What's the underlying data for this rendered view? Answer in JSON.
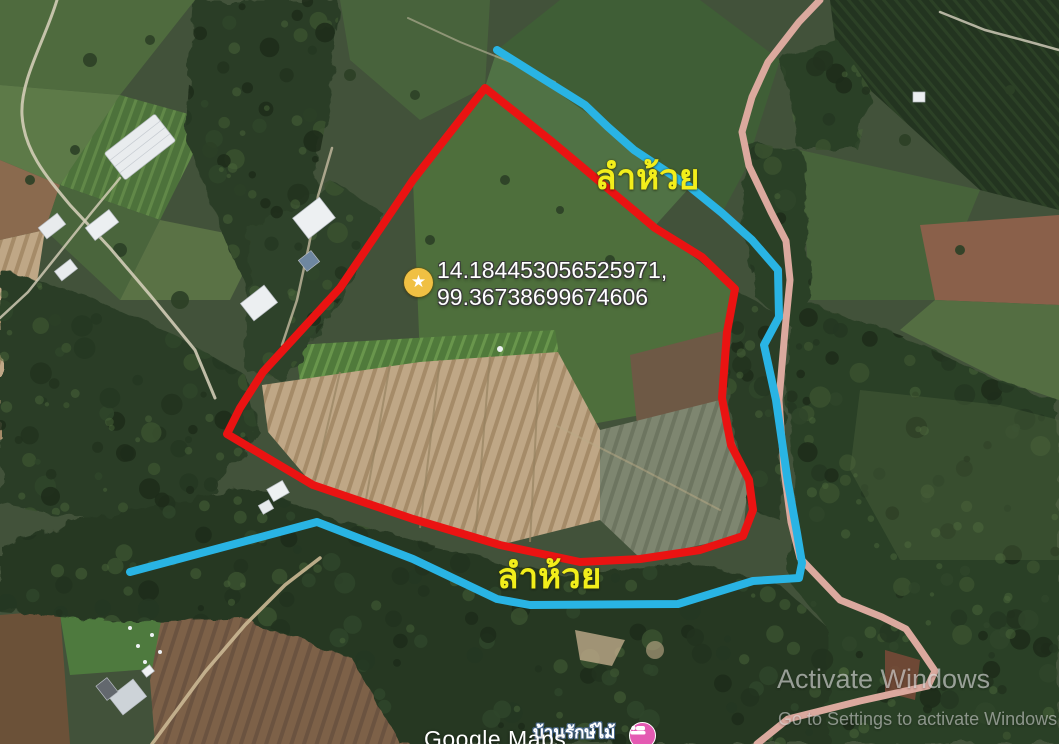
{
  "map": {
    "provider": "Google Maps",
    "marker": {
      "icon": "star-marker",
      "coordinates": [
        "14.184453056525971,",
        "99.36738699674606"
      ]
    },
    "labels": {
      "stream_top": "ลำห้วย",
      "stream_bottom": "ลำห้วย",
      "place": "บ้านรักษ์ไม้"
    },
    "overlays": {
      "road": {
        "name": "road-line",
        "color": "#dba99e",
        "width": 7,
        "closed": false,
        "points": [
          [
            820,
            0
          ],
          [
            799,
            22
          ],
          [
            768,
            62
          ],
          [
            752,
            97
          ],
          [
            742,
            132
          ],
          [
            749,
            166
          ],
          [
            771,
            212
          ],
          [
            786,
            241
          ],
          [
            790,
            280
          ],
          [
            785,
            330
          ],
          [
            779,
            400
          ],
          [
            784,
            470
          ],
          [
            791,
            522
          ],
          [
            800,
            558
          ],
          [
            840,
            600
          ],
          [
            882,
            617
          ],
          [
            906,
            629
          ],
          [
            918,
            646
          ],
          [
            935,
            671
          ],
          [
            928,
            686
          ],
          [
            860,
            701
          ],
          [
            788,
            719
          ],
          [
            757,
            744
          ]
        ]
      },
      "stream": {
        "name": "stream-line",
        "color": "#29b4e4",
        "width": 8,
        "closed": false,
        "points": [
          [
            497,
            50
          ],
          [
            585,
            105
          ],
          [
            608,
            127
          ],
          [
            634,
            150
          ],
          [
            690,
            187
          ],
          [
            722,
            213
          ],
          [
            752,
            240
          ],
          [
            778,
            270
          ],
          [
            779,
            317
          ],
          [
            764,
            345
          ],
          [
            776,
            400
          ],
          [
            788,
            483
          ],
          [
            797,
            533
          ],
          [
            802,
            563
          ],
          [
            799,
            578
          ],
          [
            753,
            581
          ],
          [
            678,
            604
          ],
          [
            530,
            605
          ],
          [
            497,
            599
          ],
          [
            413,
            559
          ],
          [
            317,
            522
          ],
          [
            130,
            572
          ]
        ]
      },
      "parcel_boundary": {
        "name": "land-parcel-outline",
        "color": "#ea1312",
        "width": 8,
        "closed": true,
        "points": [
          [
            485,
            88
          ],
          [
            550,
            140
          ],
          [
            655,
            228
          ],
          [
            702,
            257
          ],
          [
            735,
            289
          ],
          [
            727,
            332
          ],
          [
            722,
            398
          ],
          [
            731,
            445
          ],
          [
            749,
            480
          ],
          [
            753,
            510
          ],
          [
            743,
            536
          ],
          [
            700,
            550
          ],
          [
            640,
            559
          ],
          [
            580,
            562
          ],
          [
            500,
            545
          ],
          [
            413,
            519
          ],
          [
            313,
            485
          ],
          [
            227,
            434
          ],
          [
            240,
            408
          ],
          [
            263,
            372
          ],
          [
            340,
            288
          ],
          [
            413,
            180
          ]
        ]
      }
    },
    "colors": {
      "label_yellow": "#f2ee1b",
      "marker_fill": "#f0c043",
      "place_icon_pink": "#e45ab2"
    }
  },
  "watermarks": {
    "windows_line1": "Activate Windows",
    "windows_line2": "Go to Settings to activate Windows"
  }
}
